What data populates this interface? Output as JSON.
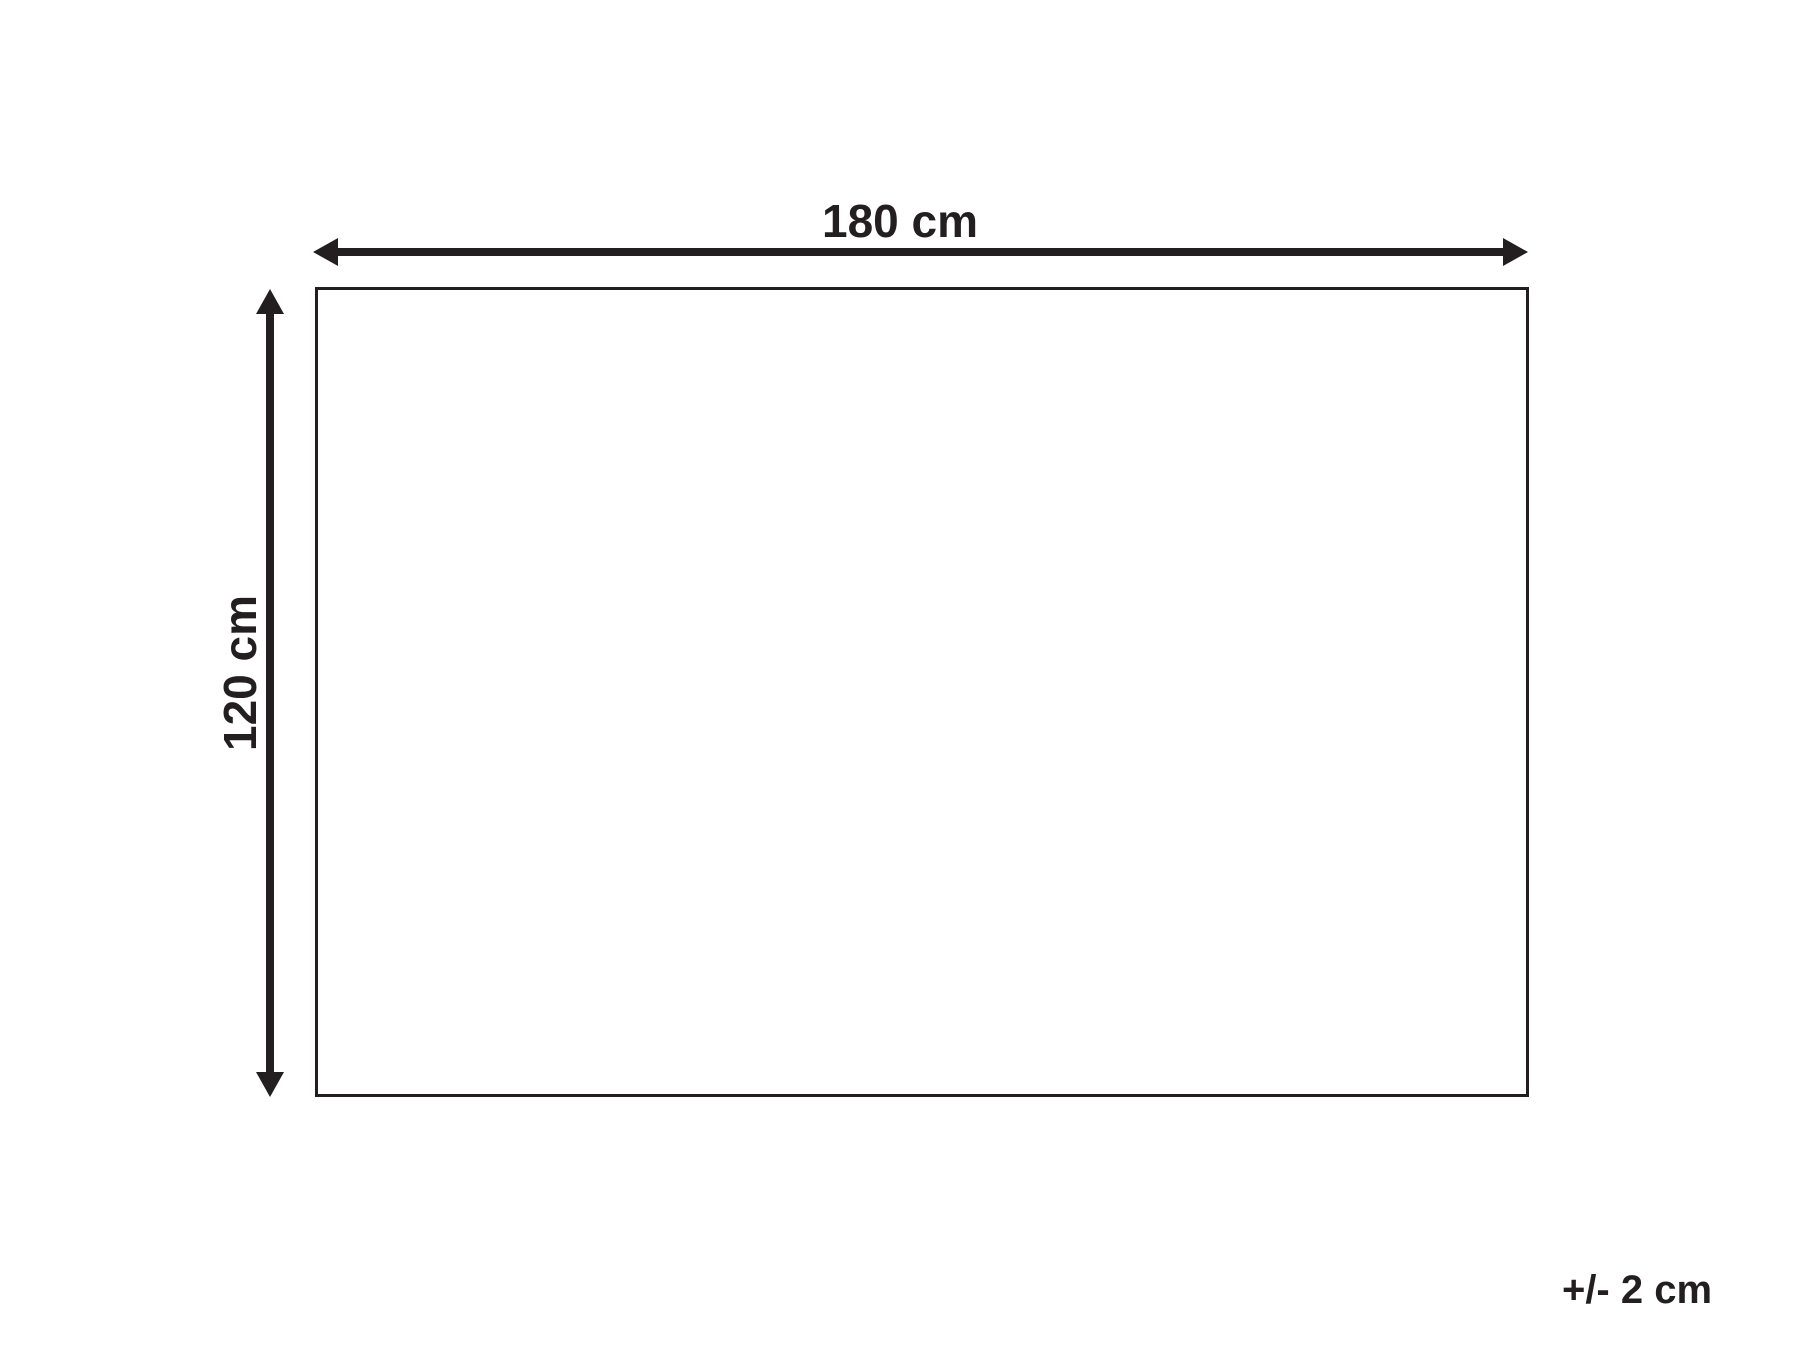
{
  "diagram": {
    "type": "dimension-diagram",
    "shape": "rectangle",
    "width_label": "180 cm",
    "height_label": "120 cm",
    "tolerance_label": "+/- 2 cm",
    "width_value_cm": 180,
    "height_value_cm": 120,
    "tolerance_cm": 2,
    "line_color": "#231f20",
    "background_color": "#ffffff"
  }
}
